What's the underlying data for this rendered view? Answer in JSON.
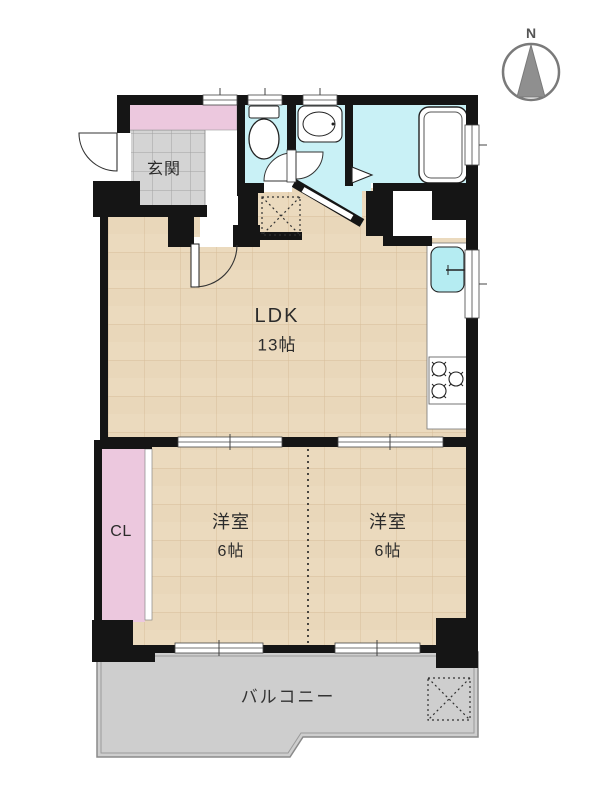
{
  "compass": {
    "label": "N"
  },
  "rooms": {
    "entrance": {
      "label": "玄関"
    },
    "ldk": {
      "label": "LDK",
      "size": "13帖"
    },
    "bedroom_left": {
      "label": "洋室",
      "size": "6帖"
    },
    "bedroom_right": {
      "label": "洋室",
      "size": "6帖"
    },
    "closet": {
      "label": "CL"
    },
    "balcony": {
      "label": "バルコニー"
    }
  },
  "colors": {
    "wall": "#151515",
    "wood_floor": "#ebdabe",
    "wet_area_cyan": "#c9f1f6",
    "closet_pink": "#ecc8de",
    "entrance_tile": "#d4d4d4",
    "balcony_gray": "#cecece",
    "compass_gray": "#8f8f8f"
  }
}
